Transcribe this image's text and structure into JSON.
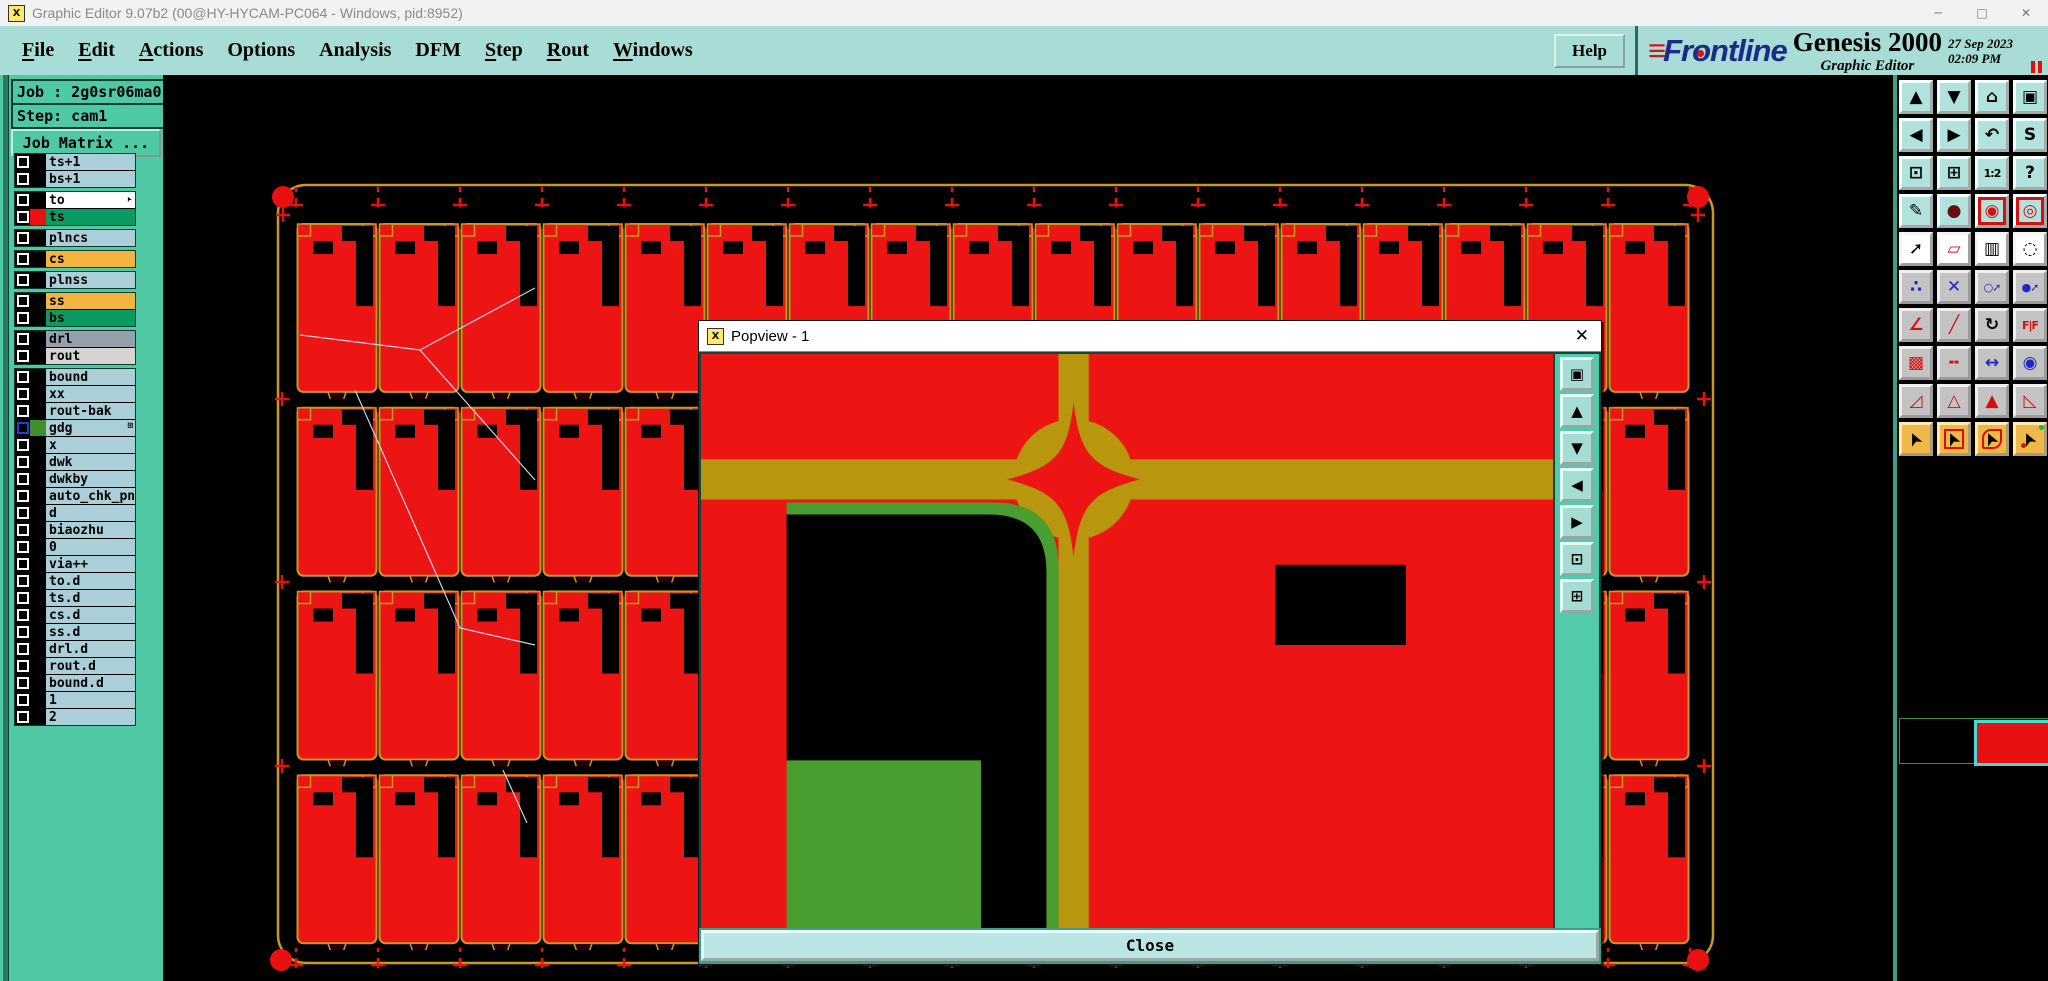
{
  "titlebar": {
    "title": "Graphic Editor 9.07b2 (00@HY-HYCAM-PC064 - Windows, pid:8952)",
    "app_icon_glyph": "X",
    "controls": [
      {
        "name": "minimize-button",
        "glyph": "─"
      },
      {
        "name": "maximize-button",
        "glyph": "□"
      },
      {
        "name": "close-button",
        "glyph": "✕"
      }
    ]
  },
  "menubar": {
    "items": [
      {
        "label": "File",
        "u": true
      },
      {
        "label": "Edit",
        "u": true
      },
      {
        "label": "Actions",
        "u": true
      },
      {
        "label": "Options",
        "u": false
      },
      {
        "label": "Analysis",
        "u": false
      },
      {
        "label": "DFM",
        "u": false
      },
      {
        "label": "Step",
        "u": true
      },
      {
        "label": "Rout",
        "u": true
      },
      {
        "label": "Windows",
        "u": true
      }
    ],
    "help_label": "Help",
    "brand": {
      "frontline_bars": "≡",
      "frontline_pre": "Fr",
      "frontline_o": "o",
      "frontline_post": "ntline",
      "product": "Genesis 2000",
      "date": "27 Sep 2023",
      "time": "02:09 PM",
      "edition": "Graphic Editor"
    }
  },
  "sidebar": {
    "job_label": "Job : 2g0sr06ma0",
    "step_label": "Step: cam1",
    "job_matrix_label": "Job Matrix ...",
    "groups": [
      {
        "rows": [
          {
            "name": "ts+1",
            "bg": "blue"
          },
          {
            "name": "bs+1",
            "bg": "blue"
          }
        ]
      },
      {
        "rows": [
          {
            "name": "to",
            "bg": "white",
            "cursor": true
          },
          {
            "name": "ts",
            "bg": "green",
            "swatch": "#ee1010"
          }
        ]
      },
      {
        "rows": [
          {
            "name": "plncs",
            "bg": "blue"
          }
        ]
      },
      {
        "rows": [
          {
            "name": "cs",
            "bg": "orange"
          }
        ]
      },
      {
        "rows": [
          {
            "name": "plnss",
            "bg": "blue"
          }
        ]
      },
      {
        "rows": [
          {
            "name": "ss",
            "bg": "orange"
          },
          {
            "name": "bs",
            "bg": "green"
          }
        ]
      },
      {
        "rows": [
          {
            "name": "drl",
            "bg": "gray"
          },
          {
            "name": "rout",
            "bg": "lightgray"
          }
        ]
      },
      {
        "rows": [
          {
            "name": "bound",
            "bg": "blue"
          },
          {
            "name": "xx",
            "bg": "blue"
          },
          {
            "name": "rout-bak",
            "bg": "blue"
          },
          {
            "name": "gdg",
            "bg": "blue",
            "cb": "blue",
            "swatch": "#3f8f2f",
            "icon": "⊞"
          },
          {
            "name": "x",
            "bg": "blue"
          },
          {
            "name": "dwk",
            "bg": "blue"
          },
          {
            "name": "dwkby",
            "bg": "blue"
          },
          {
            "name": "auto_chk_pnl",
            "bg": "blue"
          },
          {
            "name": "d",
            "bg": "blue"
          },
          {
            "name": "biaozhu",
            "bg": "blue"
          },
          {
            "name": "0",
            "bg": "blue"
          },
          {
            "name": "via++",
            "bg": "blue"
          },
          {
            "name": "to.d",
            "bg": "blue"
          },
          {
            "name": "ts.d",
            "bg": "blue"
          },
          {
            "name": "cs.d",
            "bg": "blue"
          },
          {
            "name": "ss.d",
            "bg": "blue"
          },
          {
            "name": "drl.d",
            "bg": "blue"
          },
          {
            "name": "rout.d",
            "bg": "blue"
          },
          {
            "name": "bound.d",
            "bg": "blue"
          },
          {
            "name": "1",
            "bg": "blue"
          },
          {
            "name": "2",
            "bg": "blue"
          }
        ]
      }
    ]
  },
  "popview": {
    "title": "Popview - 1",
    "icon_glyph": "X",
    "close_x_glyph": "✕",
    "close_label": "Close",
    "side_icons": [
      {
        "name": "popview-window-select-button",
        "glyph": "▣"
      },
      {
        "name": "popview-pan-up-button",
        "glyph": "▲"
      },
      {
        "name": "popview-pan-down-button",
        "glyph": "▼"
      },
      {
        "name": "popview-pan-left-button",
        "glyph": "◀"
      },
      {
        "name": "popview-pan-right-button",
        "glyph": "▶"
      },
      {
        "name": "popview-zoom-in-button",
        "glyph": "⊡"
      },
      {
        "name": "popview-zoom-out-button",
        "glyph": "⊞"
      }
    ]
  },
  "toolbar": {
    "rows": [
      {
        "style": "teal",
        "buttons": [
          {
            "name": "pan-up-button",
            "glyph": "▲"
          },
          {
            "name": "pan-down-button",
            "glyph": "▼"
          },
          {
            "name": "home-view-button",
            "glyph": "⌂"
          },
          {
            "name": "window-xy-button",
            "glyph": "▣"
          }
        ]
      },
      {
        "style": "teal",
        "buttons": [
          {
            "name": "pan-left-button",
            "glyph": "◀"
          },
          {
            "name": "pan-right-button",
            "glyph": "▶"
          },
          {
            "name": "undo-view-button",
            "glyph": "↶"
          },
          {
            "name": "s-route-button",
            "glyph": "S"
          }
        ]
      },
      {
        "style": "teal",
        "buttons": [
          {
            "name": "zoom-out-button",
            "glyph": "⊡"
          },
          {
            "name": "zoom-in-button",
            "glyph": "⊞"
          },
          {
            "name": "scale-1-2-button",
            "glyph": "1:2",
            "small": true
          },
          {
            "name": "help-query-button",
            "glyph": "?"
          }
        ]
      },
      {
        "style": "teal",
        "buttons": [
          {
            "name": "edit-tools-button",
            "glyph": "✎"
          },
          {
            "name": "trace-pad-button",
            "glyph": "●",
            "fg": "#6a0c0c"
          },
          {
            "name": "netlist-check-button",
            "glyph": "◉",
            "fg": "#d80f0f",
            "red": true
          },
          {
            "name": "netlist-compare-button",
            "glyph": "◎",
            "fg": "#d80f0f",
            "red": true
          }
        ]
      },
      {
        "style": "white",
        "buttons": [
          {
            "name": "move-pad-button",
            "glyph": "➚"
          },
          {
            "name": "polygon-select-button",
            "glyph": "▱",
            "fg": "#d80f0f"
          },
          {
            "name": "ruler-measure-button",
            "glyph": "▥"
          },
          {
            "name": "thermal-pad-button",
            "glyph": "◌"
          }
        ]
      },
      {
        "style": "gray",
        "buttons": [
          {
            "name": "net-points-button",
            "glyph": "∴",
            "fg": "#1c28c8"
          },
          {
            "name": "delete-marker-button",
            "glyph": "✕",
            "fg": "#1c28c8"
          },
          {
            "name": "route-from-via-button",
            "glyph": "○➚",
            "small": true,
            "fg": "#1c28c8"
          },
          {
            "name": "route-from-pad-button",
            "glyph": "●➚",
            "small": true,
            "fg": "#1c28c8"
          }
        ]
      },
      {
        "style": "gray",
        "buttons": [
          {
            "name": "angle-measure-button",
            "glyph": "∠",
            "fg": "#d80f0f"
          },
          {
            "name": "diagonal-line-button",
            "glyph": "╱",
            "fg": "#d80f0f"
          },
          {
            "name": "rotate-button",
            "glyph": "↻"
          },
          {
            "name": "mirror-ff-button",
            "glyph": "F|F",
            "small": true,
            "fg": "#d80f0f"
          }
        ]
      },
      {
        "style": "gray",
        "buttons": [
          {
            "name": "copy-pad-button",
            "glyph": "▩",
            "fg": "#d80f0f"
          },
          {
            "name": "stretch-line-button",
            "glyph": "╍",
            "fg": "#d80f0f"
          },
          {
            "name": "distance-measure-button",
            "glyph": "↔",
            "fg": "#1c28c8"
          },
          {
            "name": "overlap-circles-button",
            "glyph": "◉",
            "fg": "#1c28c8"
          }
        ]
      },
      {
        "style": "gray",
        "buttons": [
          {
            "name": "triangle-tool-1-button",
            "glyph": "◿",
            "fg": "#d80f0f"
          },
          {
            "name": "triangle-tool-2-button",
            "glyph": "△",
            "fg": "#d80f0f"
          },
          {
            "name": "triangle-tool-3-button",
            "glyph": "▲",
            "fg": "#d80f0f"
          },
          {
            "name": "triangle-tool-4-button",
            "glyph": "◺",
            "fg": "#d80f0f"
          }
        ]
      },
      {
        "style": "orange",
        "buttons": [
          {
            "name": "select-cursor-button",
            "glyph": "➤",
            "cursor": true
          },
          {
            "name": "select-frame-cursor-button",
            "glyph": "➤",
            "cursor": true,
            "frame": "square"
          },
          {
            "name": "select-poly-cursor-button",
            "glyph": "➤",
            "cursor": true,
            "frame": "poly"
          },
          {
            "name": "select-net-cursor-button",
            "glyph": "➤",
            "cursor": true,
            "frame": "net"
          }
        ]
      }
    ]
  },
  "icons": {
    "layer_cursor": "➤"
  },
  "colors": {
    "panel_teal": "#4fc9a4",
    "menubar_cyan": "#a8dcd6",
    "pcb_red": "#ed1414",
    "pcb_gold": "#c89b20",
    "popview_olive": "#b8960e",
    "popview_green": "#4a9e2f",
    "layer_blue": "#aacfd8",
    "layer_orange": "#f2b43e",
    "layer_green": "#0b9a62",
    "selection_cyan": "#49d8d8",
    "brand_blue": "#1c2a88",
    "accent_red": "#d61616"
  }
}
